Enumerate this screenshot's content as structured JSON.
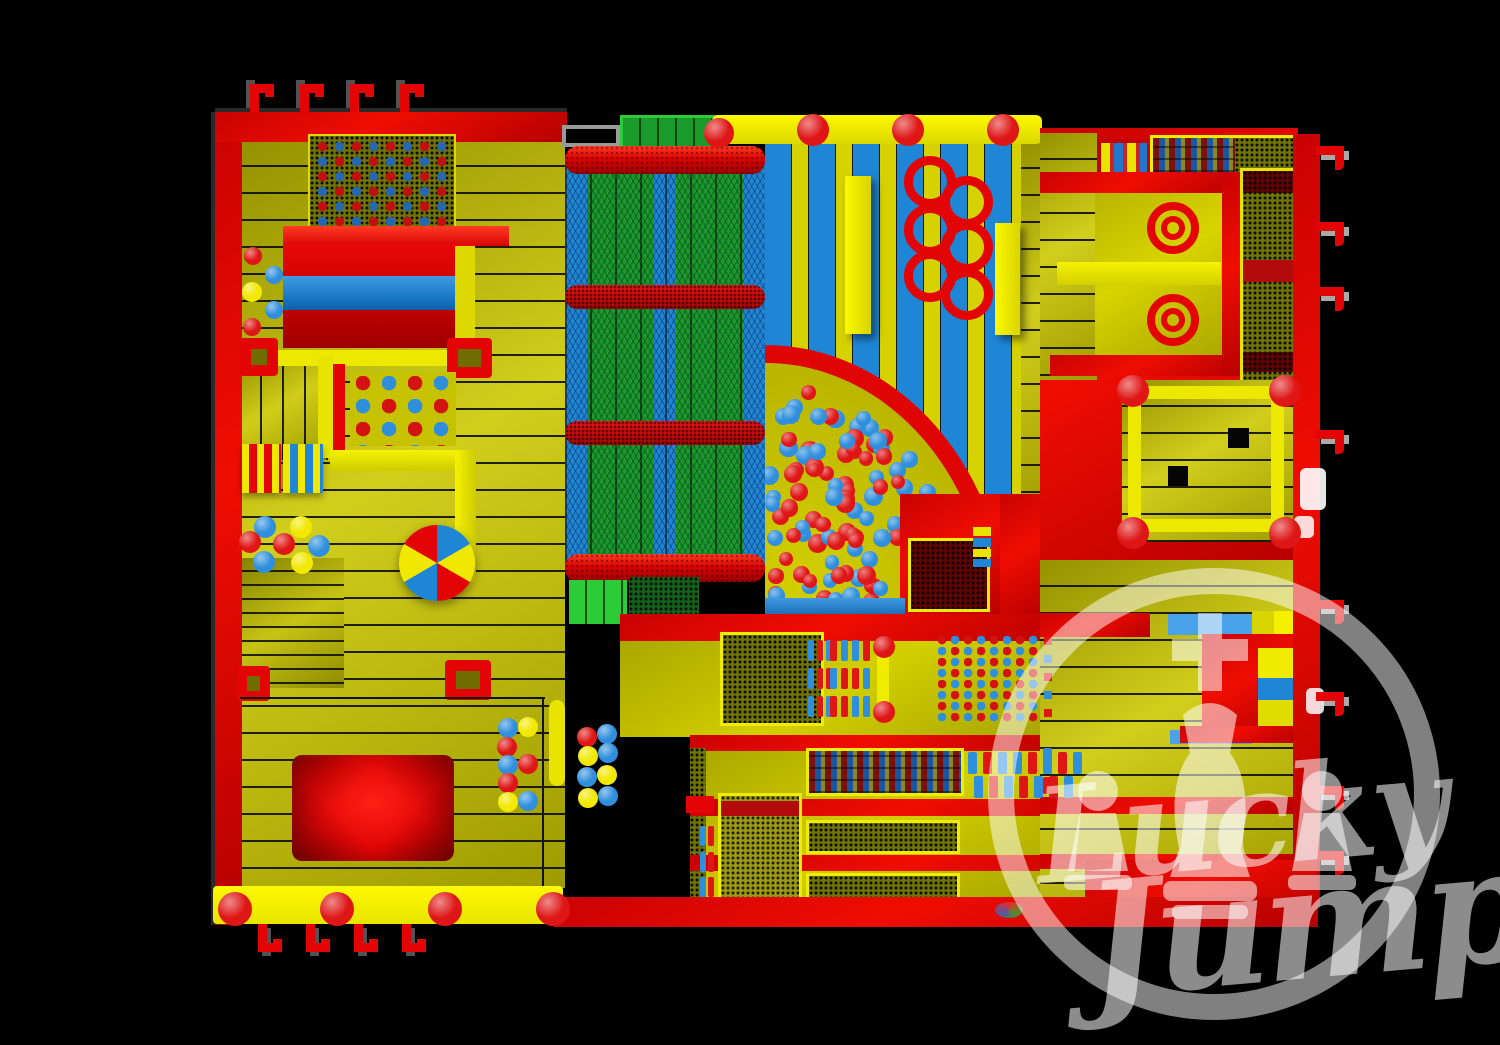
{
  "watermark": {
    "line1": "Lucky",
    "line2": "Jump"
  },
  "colors": {
    "background": "#000000",
    "red": "#e30505",
    "redBright": "#ff3b22",
    "redDeep": "#9d0000",
    "floor": "#c6c200",
    "floorBright": "#f2ee00",
    "yellow": "#d8d400",
    "blue": "#1f86d6",
    "blueLight": "#4aa2e8",
    "green": "#1b9a2c",
    "greenBright": "#2ccc39",
    "olive": "#9c9a14",
    "oliveDark": "#6f7404",
    "meshRed": "#5e0404",
    "white": "#ffffff"
  },
  "ball_pit": {
    "count": 112,
    "colors": [
      "#df1616",
      "#2f8fdd"
    ]
  }
}
